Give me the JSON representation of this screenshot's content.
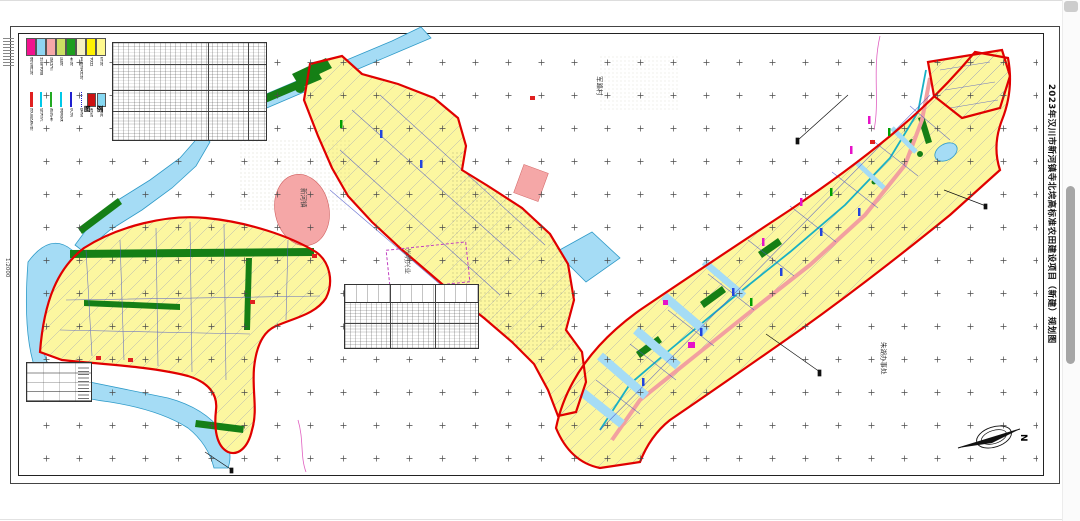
{
  "titleblock": {
    "title": "2023年汉川市新河镇寺北垸高标准农田建设项目（新建）规划图"
  },
  "scale": {
    "label": "1:2000"
  },
  "north": {
    "label": "N"
  },
  "legend": {
    "title": "图 例",
    "area_items": [
      {
        "label": "建设用地",
        "color": "#F2138F"
      },
      {
        "label": "坑塘水面",
        "color": "#8FD6F2"
      },
      {
        "label": "居民点",
        "color": "#F6A8A8"
      },
      {
        "label": "园地",
        "color": "#CBDF62"
      },
      {
        "label": "林地",
        "color": "#1E9E1E"
      },
      {
        "label": "其他农用地",
        "color": "#F5F0C2"
      },
      {
        "label": "水田",
        "color": "#FFF200"
      },
      {
        "label": "旱地",
        "color": "#FFF98E"
      }
    ],
    "line_items": [
      {
        "label": "项目区界线",
        "color": "#E02020",
        "style": "bar"
      },
      {
        "label": "排水沟",
        "color": "#00C8E8",
        "style": "line"
      },
      {
        "label": "防护林",
        "color": "#22AA22",
        "style": "line"
      },
      {
        "label": "灌溉渠",
        "color": "#00C8E8",
        "style": "line"
      },
      {
        "label": "河流",
        "color": "#2020D0",
        "style": "line"
      },
      {
        "label": "管道",
        "color": "#2020D0",
        "style": "dots"
      },
      {
        "label": "泵站",
        "color": "#CC1111",
        "style": "rect"
      },
      {
        "label": "涵闸",
        "color": "#86D8F2",
        "style": "rect"
      }
    ]
  },
  "map_labels": [
    {
      "text": "军路村",
      "x": 596,
      "y": 76,
      "color": "#333333"
    },
    {
      "text": "新河镇",
      "x": 300,
      "y": 188,
      "color": "#444444"
    },
    {
      "text": "光明兴业",
      "x": 404,
      "y": 248,
      "color": "#555555"
    },
    {
      "text": "朱湖办事处",
      "x": 880,
      "y": 342,
      "color": "#333333"
    }
  ],
  "colors": {
    "parcel_fill": "#FCF7A0",
    "water": "#A5DCF5",
    "project_boundary": "#E00000",
    "forest": "#157F15",
    "residential": "#F5A7A7",
    "road": "#F2A0A0"
  }
}
